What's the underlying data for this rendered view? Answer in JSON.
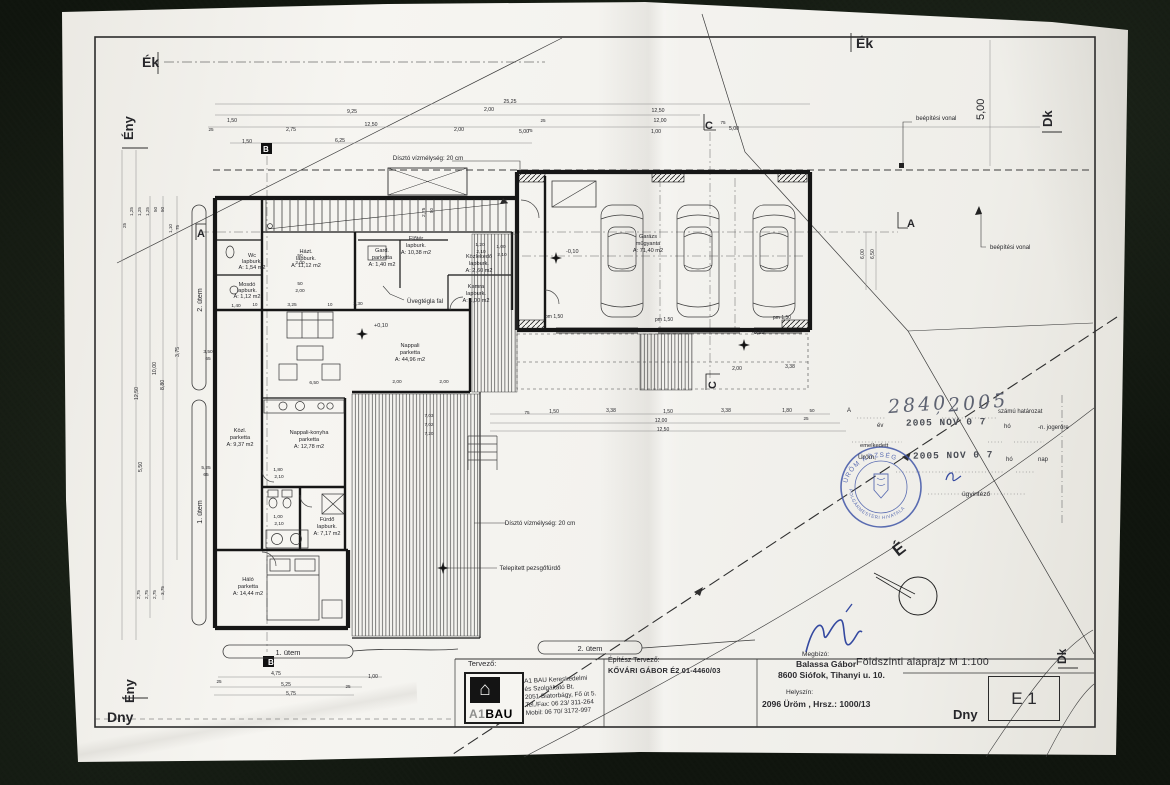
{
  "colors": {
    "ink": "#26262a",
    "dim": "#6f6f6f",
    "stamp_blue": "#4156a8",
    "signature_blue": "#3449a0",
    "paper": "#f3f2ee",
    "background": "#10150e"
  },
  "sheet": {
    "title_block": {
      "tervezo_label": "Tervező:",
      "logo_prefix": "A1",
      "logo_text": "BAU",
      "logo_icon": "house-icon",
      "company_lines": [
        "A1 BAU Kereskedelmi",
        "és Szolgáltató Bt.",
        "2051 Biatorbágy, Fő út 5.",
        "Tel./Fax: 06 23/ 311-264",
        "Mobil:  06 70/ 3172-997"
      ],
      "epitesz_label": "Építész Tervező:",
      "epitesz_name": "KŐVÁRI GÁBOR  É2 01-4460/03",
      "megbizo_label": "Megbízó:",
      "megbizo_name": "Balassa Gábor",
      "megbizo_address": "8600 Siófok, Tihanyi u. 10.",
      "helyszin_label": "Helyszín:",
      "helyszin_value": "2096 Üröm , Hrsz.: 1000/13",
      "drawing_title": "Földszinti alaprajz M 1:100",
      "sheet_no": "E 1"
    },
    "stamp": {
      "ref_letter": "A",
      "number_hand": "2840",
      "comma": ",",
      "year_hand": "2005",
      "szamu": "számú határozat",
      "ev_label": "év",
      "date_stamp_1": "2005 NOV 0 7",
      "ho_1": "hó",
      "jogerore": "-n. jogerőre",
      "emelkedett": "emelkedett",
      "urom": "Üröm,",
      "date_stamp_2": "2005 NOV 0 7",
      "ho_2": "hó",
      "nap_label": "nap",
      "ugyintezo": "ügyintéző",
      "ring_top": "ÜRÖM KÖZSÉG",
      "ring_bottom": "POLGÁRMESTERI HIVATALA"
    }
  },
  "plan": {
    "texts": [
      {
        "n": "corner-ek-left",
        "t": "Ék",
        "x": 142,
        "y": 67,
        "s": 14,
        "b": 1
      },
      {
        "n": "corner-ek-top",
        "t": "Ék",
        "x": 856,
        "y": 48,
        "s": 14,
        "b": 1
      },
      {
        "n": "corner-eny-top",
        "t": "Ény",
        "x": 133,
        "y": 140,
        "s": 13,
        "b": 1,
        "r": -90
      },
      {
        "n": "corner-eny-bottom",
        "t": "Ény",
        "x": 134,
        "y": 703,
        "s": 13,
        "b": 1,
        "r": -90
      },
      {
        "n": "corner-dny-left",
        "t": "Dny",
        "x": 107,
        "y": 722,
        "s": 14,
        "b": 1
      },
      {
        "n": "corner-dny-right",
        "t": "Dny",
        "x": 953,
        "y": 719,
        "s": 13,
        "b": 1
      },
      {
        "n": "corner-dk-top",
        "t": "Dk",
        "x": 1052,
        "y": 127,
        "s": 13,
        "b": 1,
        "r": -90
      },
      {
        "n": "corner-dk-bottom",
        "t": "Dk",
        "x": 1066,
        "y": 664,
        "s": 12,
        "b": 1,
        "r": -90
      },
      {
        "n": "side-dim-5m",
        "t": "5,00",
        "x": 984,
        "y": 120,
        "s": 11,
        "r": -90
      },
      {
        "n": "section-a-left",
        "t": "A",
        "x": 197,
        "y": 237,
        "s": 11,
        "b": 1
      },
      {
        "n": "section-a-right",
        "t": "A",
        "x": 907,
        "y": 227,
        "s": 11,
        "b": 1
      },
      {
        "n": "section-b-top",
        "t": "B",
        "x": 263,
        "y": 152,
        "s": 8,
        "b": 1,
        "c": "#ffffff"
      },
      {
        "n": "section-b-bottom",
        "t": "B",
        "x": 268,
        "y": 665,
        "s": 8,
        "b": 1,
        "c": "#ffffff"
      },
      {
        "n": "section-c-top",
        "t": "C",
        "x": 705,
        "y": 129,
        "s": 11,
        "b": 1
      },
      {
        "n": "section-c-bottom",
        "t": "C",
        "x": 716,
        "y": 389,
        "s": 11,
        "b": 1,
        "r": -90
      },
      {
        "n": "room-label",
        "t": "Wc",
        "x": 252,
        "y": 257,
        "a": "m"
      },
      {
        "n": "room-label",
        "t": "lapburk.",
        "x": 252,
        "y": 263,
        "a": "m"
      },
      {
        "n": "room-label",
        "t": "A: 1,54 m2",
        "x": 252,
        "y": 269,
        "a": "m"
      },
      {
        "n": "room-label",
        "t": "Mosdó",
        "x": 247,
        "y": 286,
        "a": "m"
      },
      {
        "n": "room-label",
        "t": "lapburk.",
        "x": 247,
        "y": 292,
        "a": "m"
      },
      {
        "n": "room-label",
        "t": "A: 1,12 m2",
        "x": 247,
        "y": 298,
        "a": "m"
      },
      {
        "n": "room-label",
        "t": "Házt.",
        "x": 306,
        "y": 253,
        "a": "m"
      },
      {
        "n": "room-label",
        "t": "lapburk.",
        "x": 306,
        "y": 260,
        "a": "m"
      },
      {
        "n": "room-label",
        "t": "A: 11,12 m2",
        "x": 306,
        "y": 267,
        "a": "m"
      },
      {
        "n": "room-label",
        "t": "Gard.",
        "x": 382,
        "y": 252,
        "a": "m"
      },
      {
        "n": "room-label",
        "t": "parketta",
        "x": 382,
        "y": 259,
        "a": "m"
      },
      {
        "n": "room-label",
        "t": "A: 1,40 m2",
        "x": 382,
        "y": 266,
        "a": "m"
      },
      {
        "n": "room-label",
        "t": "Kamra",
        "x": 476,
        "y": 288,
        "a": "m"
      },
      {
        "n": "room-label",
        "t": "lapburk.",
        "x": 476,
        "y": 295,
        "a": "m"
      },
      {
        "n": "room-label",
        "t": "A: 1,00 m2",
        "x": 476,
        "y": 302,
        "a": "m"
      },
      {
        "n": "room-label",
        "t": "Előtér",
        "x": 416,
        "y": 240,
        "a": "m"
      },
      {
        "n": "room-label",
        "t": "lapburk.",
        "x": 416,
        "y": 247,
        "a": "m"
      },
      {
        "n": "room-label",
        "t": "A: 10,38 m2",
        "x": 416,
        "y": 254,
        "a": "m"
      },
      {
        "n": "room-label",
        "t": "Közlekedő",
        "x": 479,
        "y": 258,
        "a": "m"
      },
      {
        "n": "room-label",
        "t": "lapburk.",
        "x": 479,
        "y": 265,
        "a": "m"
      },
      {
        "n": "room-label",
        "t": "A: 2,60 m2",
        "x": 479,
        "y": 272,
        "a": "m"
      },
      {
        "n": "room-label",
        "t": "Nappali",
        "x": 410,
        "y": 347,
        "a": "m"
      },
      {
        "n": "room-label",
        "t": "parketta",
        "x": 410,
        "y": 354,
        "a": "m"
      },
      {
        "n": "room-label",
        "t": "A: 44,96 m2",
        "x": 410,
        "y": 361,
        "a": "m"
      },
      {
        "n": "room-label",
        "t": "Nappali-konyha",
        "x": 309,
        "y": 434,
        "a": "m"
      },
      {
        "n": "room-label",
        "t": "parketta",
        "x": 309,
        "y": 441,
        "a": "m"
      },
      {
        "n": "room-label",
        "t": "A: 12,78 m2",
        "x": 309,
        "y": 448,
        "a": "m"
      },
      {
        "n": "room-label",
        "t": "Közl.",
        "x": 240,
        "y": 432,
        "a": "m"
      },
      {
        "n": "room-label",
        "t": "parketta",
        "x": 240,
        "y": 439,
        "a": "m"
      },
      {
        "n": "room-label",
        "t": "A: 9,37 m2",
        "x": 240,
        "y": 446,
        "a": "m"
      },
      {
        "n": "room-label",
        "t": "Fürdő",
        "x": 327,
        "y": 521,
        "a": "m"
      },
      {
        "n": "room-label",
        "t": "lapburk.",
        "x": 327,
        "y": 528,
        "a": "m"
      },
      {
        "n": "room-label",
        "t": "A: 7,17 m2",
        "x": 327,
        "y": 535,
        "a": "m"
      },
      {
        "n": "room-label",
        "t": "Háló",
        "x": 248,
        "y": 581,
        "a": "m"
      },
      {
        "n": "room-label",
        "t": "parketta",
        "x": 248,
        "y": 588,
        "a": "m"
      },
      {
        "n": "room-label",
        "t": "A: 14,44 m2",
        "x": 248,
        "y": 595,
        "a": "m"
      },
      {
        "n": "room-label",
        "t": "Garázs",
        "x": 648,
        "y": 238,
        "a": "m"
      },
      {
        "n": "room-label",
        "t": "műgyanta",
        "x": 648,
        "y": 245,
        "a": "m"
      },
      {
        "n": "room-label",
        "t": "A: 71,40 m2",
        "x": 648,
        "y": 252,
        "a": "m"
      },
      {
        "n": "pond-note-1",
        "t": "Dísztó  vízmélység: 20 cm",
        "x": 428,
        "y": 160,
        "s": 6.2,
        "a": "m"
      },
      {
        "n": "pond-note-2",
        "t": "Dísztó  vízmélység: 20 cm",
        "x": 540,
        "y": 525,
        "s": 6.2,
        "a": "m"
      },
      {
        "n": "glass-wall-note",
        "t": "Üvegtégla fal",
        "x": 407,
        "y": 303,
        "s": 6.2
      },
      {
        "n": "jacuzzi-note",
        "t": "Telepített pezsgőfürdő",
        "x": 530,
        "y": 570,
        "s": 6.2,
        "a": "m"
      },
      {
        "n": "building-line-note-1",
        "t": "beépítési vonal",
        "x": 916,
        "y": 120,
        "s": 6
      },
      {
        "n": "building-line-note-2",
        "t": "beépítési vonal",
        "x": 990,
        "y": 249,
        "s": 6
      },
      {
        "n": "phase1-bottom",
        "t": "1. ütem",
        "x": 288,
        "y": 655,
        "s": 7.5,
        "a": "m"
      },
      {
        "n": "phase2-bottom",
        "t": "2. ütem",
        "x": 590,
        "y": 651,
        "s": 7.5,
        "a": "m"
      },
      {
        "n": "phase2-left",
        "t": "2. ütem",
        "x": 202,
        "y": 300,
        "s": 7,
        "r": -90,
        "a": "m"
      },
      {
        "n": "phase1-left",
        "t": "1. ütem",
        "x": 202,
        "y": 512,
        "s": 7,
        "r": -90,
        "a": "m"
      },
      {
        "n": "level-mark",
        "t": "+0,10",
        "x": 374,
        "y": 327,
        "s": 5.5
      },
      {
        "n": "level-mark",
        "t": "-0,10",
        "x": 566,
        "y": 253,
        "s": 5.5
      },
      {
        "n": "level-mark",
        "t": "-0,25",
        "x": 752,
        "y": 334,
        "s": 5.5
      },
      {
        "n": "pm-mark",
        "t": "pm 1,50",
        "x": 545,
        "y": 318,
        "s": 5
      },
      {
        "n": "pm-mark",
        "t": "pm 1,50",
        "x": 655,
        "y": 321,
        "s": 5
      },
      {
        "n": "pm-mark",
        "t": "pm 1,50",
        "x": 773,
        "y": 319,
        "s": 5
      },
      {
        "t": "25,25",
        "x": 510,
        "y": 103,
        "s": 5.2,
        "a": "m"
      },
      {
        "t": "9,25",
        "x": 352,
        "y": 113,
        "s": 5.2,
        "a": "m"
      },
      {
        "t": "2,00",
        "x": 489,
        "y": 111,
        "s": 5.2,
        "a": "m"
      },
      {
        "t": "25",
        "x": 543,
        "y": 122,
        "s": 4.6,
        "a": "m"
      },
      {
        "t": "12,50",
        "x": 658,
        "y": 112,
        "s": 5.2,
        "a": "m"
      },
      {
        "t": "12,00",
        "x": 660,
        "y": 122,
        "s": 5.2,
        "a": "m"
      },
      {
        "t": "1,00",
        "x": 656,
        "y": 133,
        "s": 5.2,
        "a": "m"
      },
      {
        "t": "5,00",
        "x": 734,
        "y": 130,
        "s": 5.2,
        "a": "m"
      },
      {
        "t": "75",
        "x": 723,
        "y": 124,
        "s": 4.6,
        "a": "m"
      },
      {
        "t": "5,00",
        "x": 524,
        "y": 133,
        "s": 5.2,
        "a": "m"
      },
      {
        "t": "1,50",
        "x": 232,
        "y": 122,
        "s": 5.2,
        "a": "m"
      },
      {
        "t": "25",
        "x": 211,
        "y": 131,
        "s": 4.6,
        "a": "m"
      },
      {
        "t": "2,75",
        "x": 291,
        "y": 131,
        "s": 5.2,
        "a": "m"
      },
      {
        "t": "2,00",
        "x": 459,
        "y": 131,
        "s": 5.2,
        "a": "m"
      },
      {
        "t": "75",
        "x": 530,
        "y": 132,
        "s": 4.6,
        "a": "m"
      },
      {
        "t": "12,50",
        "x": 371,
        "y": 126,
        "s": 5.2,
        "a": "m"
      },
      {
        "t": "6,25",
        "x": 340,
        "y": 142,
        "s": 5.2,
        "a": "m"
      },
      {
        "t": "1,50",
        "x": 247,
        "y": 143,
        "s": 5.2,
        "a": "m"
      },
      {
        "t": "12,50",
        "x": 138,
        "y": 400,
        "s": 5.2,
        "r": -90
      },
      {
        "t": "10,00",
        "x": 156,
        "y": 375,
        "s": 5.2,
        "r": -90
      },
      {
        "t": "8,80",
        "x": 164,
        "y": 390,
        "s": 5.2,
        "r": -90
      },
      {
        "t": "3,75",
        "x": 179,
        "y": 357,
        "s": 5.2,
        "r": -90
      },
      {
        "t": "5,50",
        "x": 142,
        "y": 472,
        "s": 5.2,
        "r": -90
      },
      {
        "t": "1,25",
        "x": 133,
        "y": 216,
        "s": 4.6,
        "r": -90
      },
      {
        "t": "1,25",
        "x": 141,
        "y": 216,
        "s": 4.6,
        "r": -90
      },
      {
        "t": "1,25",
        "x": 149,
        "y": 216,
        "s": 4.6,
        "r": -90
      },
      {
        "t": "50",
        "x": 157,
        "y": 212,
        "s": 4.6,
        "r": -90
      },
      {
        "t": "50",
        "x": 164,
        "y": 212,
        "s": 4.6,
        "r": -90
      },
      {
        "t": "1,10",
        "x": 172,
        "y": 233,
        "s": 4.6,
        "r": -90
      },
      {
        "t": "75",
        "x": 179,
        "y": 230,
        "s": 4.6,
        "r": -90
      },
      {
        "t": "25",
        "x": 126,
        "y": 228,
        "s": 4.6,
        "r": -90
      },
      {
        "t": "2,75",
        "x": 140,
        "y": 599,
        "s": 4.6,
        "r": -90
      },
      {
        "t": "2,75",
        "x": 148,
        "y": 599,
        "s": 4.6,
        "r": -90
      },
      {
        "t": "2,75",
        "x": 156,
        "y": 599,
        "s": 4.6,
        "r": -90
      },
      {
        "t": "3,75",
        "x": 164,
        "y": 595,
        "s": 4.6,
        "r": -90
      },
      {
        "t": "50",
        "x": 300,
        "y": 257,
        "s": 4.8,
        "a": "m"
      },
      {
        "t": "2,00",
        "x": 300,
        "y": 264,
        "s": 4.8,
        "a": "m"
      },
      {
        "t": "50",
        "x": 300,
        "y": 285,
        "s": 4.8,
        "a": "m"
      },
      {
        "t": "2,00",
        "x": 300,
        "y": 292,
        "s": 4.8,
        "a": "m"
      },
      {
        "t": "3,50",
        "x": 208,
        "y": 353,
        "s": 4.8,
        "a": "m"
      },
      {
        "t": "65",
        "x": 208,
        "y": 360,
        "s": 4.8,
        "a": "m"
      },
      {
        "t": "5,25",
        "x": 206,
        "y": 469,
        "s": 4.8,
        "a": "m"
      },
      {
        "t": "65",
        "x": 206,
        "y": 476,
        "s": 4.8,
        "a": "m"
      },
      {
        "t": "1,40",
        "x": 236,
        "y": 307,
        "s": 4.8,
        "a": "m"
      },
      {
        "t": "10",
        "x": 255,
        "y": 306,
        "s": 4.4,
        "a": "m"
      },
      {
        "t": "3,25",
        "x": 292,
        "y": 306,
        "s": 4.8,
        "a": "m"
      },
      {
        "t": "10",
        "x": 330,
        "y": 306,
        "s": 4.4,
        "a": "m"
      },
      {
        "t": "2,30",
        "x": 358,
        "y": 305,
        "s": 4.8,
        "a": "m"
      },
      {
        "t": "6,50",
        "x": 314,
        "y": 384,
        "s": 4.8,
        "a": "m"
      },
      {
        "t": "2,00",
        "x": 397,
        "y": 383,
        "s": 4.8,
        "a": "m"
      },
      {
        "t": "2,00",
        "x": 444,
        "y": 383,
        "s": 4.8,
        "a": "m"
      },
      {
        "t": "1,20",
        "x": 480,
        "y": 246,
        "s": 4.8,
        "a": "m"
      },
      {
        "t": "2,10",
        "x": 481,
        "y": 253,
        "s": 4.8,
        "a": "m"
      },
      {
        "t": "1,00",
        "x": 501,
        "y": 248,
        "s": 4.8,
        "a": "m"
      },
      {
        "t": "2,10",
        "x": 502,
        "y": 256,
        "s": 4.8,
        "a": "m"
      },
      {
        "t": "1,80",
        "x": 278,
        "y": 471,
        "s": 4.8,
        "a": "m"
      },
      {
        "t": "2,10",
        "x": 279,
        "y": 478,
        "s": 4.8,
        "a": "m"
      },
      {
        "t": "1,00",
        "x": 278,
        "y": 518,
        "s": 4.8,
        "a": "m"
      },
      {
        "t": "2,10",
        "x": 279,
        "y": 525,
        "s": 4.8,
        "a": "m"
      },
      {
        "t": "2,75",
        "x": 425,
        "y": 217,
        "s": 4.8,
        "r": -90
      },
      {
        "t": "50",
        "x": 433,
        "y": 213,
        "s": 4.4,
        "r": -90
      },
      {
        "t": "4,75",
        "x": 276,
        "y": 675,
        "s": 5,
        "a": "m"
      },
      {
        "t": "1,00",
        "x": 373,
        "y": 678,
        "s": 5,
        "a": "m"
      },
      {
        "t": "25",
        "x": 219,
        "y": 683,
        "s": 4.6,
        "a": "m"
      },
      {
        "t": "5,25",
        "x": 286,
        "y": 686,
        "s": 5,
        "a": "m"
      },
      {
        "t": "25",
        "x": 348,
        "y": 688,
        "s": 4.6,
        "a": "m"
      },
      {
        "t": "5,75",
        "x": 291,
        "y": 695,
        "s": 5,
        "a": "m"
      },
      {
        "t": "75",
        "x": 527,
        "y": 414,
        "s": 4.6,
        "a": "m"
      },
      {
        "t": "1,50",
        "x": 554,
        "y": 413,
        "s": 5,
        "a": "m"
      },
      {
        "t": "3,38",
        "x": 611,
        "y": 412,
        "s": 5,
        "a": "m"
      },
      {
        "t": "1,50",
        "x": 668,
        "y": 413,
        "s": 5,
        "a": "m"
      },
      {
        "t": "3,38",
        "x": 726,
        "y": 412,
        "s": 5,
        "a": "m"
      },
      {
        "t": "1,80",
        "x": 787,
        "y": 412,
        "s": 5,
        "a": "m"
      },
      {
        "t": "50",
        "x": 812,
        "y": 412,
        "s": 4.6,
        "a": "m"
      },
      {
        "t": "25",
        "x": 806,
        "y": 420,
        "s": 4.6,
        "a": "m"
      },
      {
        "t": "12,00",
        "x": 661,
        "y": 422,
        "s": 5,
        "a": "m"
      },
      {
        "t": "12,50",
        "x": 663,
        "y": 431,
        "s": 5,
        "a": "m"
      },
      {
        "t": "2,00",
        "x": 737,
        "y": 370,
        "s": 5,
        "a": "m"
      },
      {
        "t": "3,38",
        "x": 790,
        "y": 368,
        "s": 5,
        "a": "m"
      },
      {
        "t": "6,00",
        "x": 864,
        "y": 259,
        "s": 5,
        "r": -90
      },
      {
        "t": "6,50",
        "x": 874,
        "y": 259,
        "s": 5,
        "r": -90
      },
      {
        "t": "7,03",
        "x": 429,
        "y": 417,
        "s": 4.6,
        "a": "m"
      },
      {
        "t": "7,02",
        "x": 429,
        "y": 426,
        "s": 4.6,
        "a": "m"
      },
      {
        "t": "7,20",
        "x": 429,
        "y": 435,
        "s": 4.6,
        "a": "m"
      },
      {
        "n": "north-letter",
        "t": "É",
        "x": 898,
        "y": 557,
        "s": 17,
        "b": 1,
        "r": -38
      }
    ]
  }
}
